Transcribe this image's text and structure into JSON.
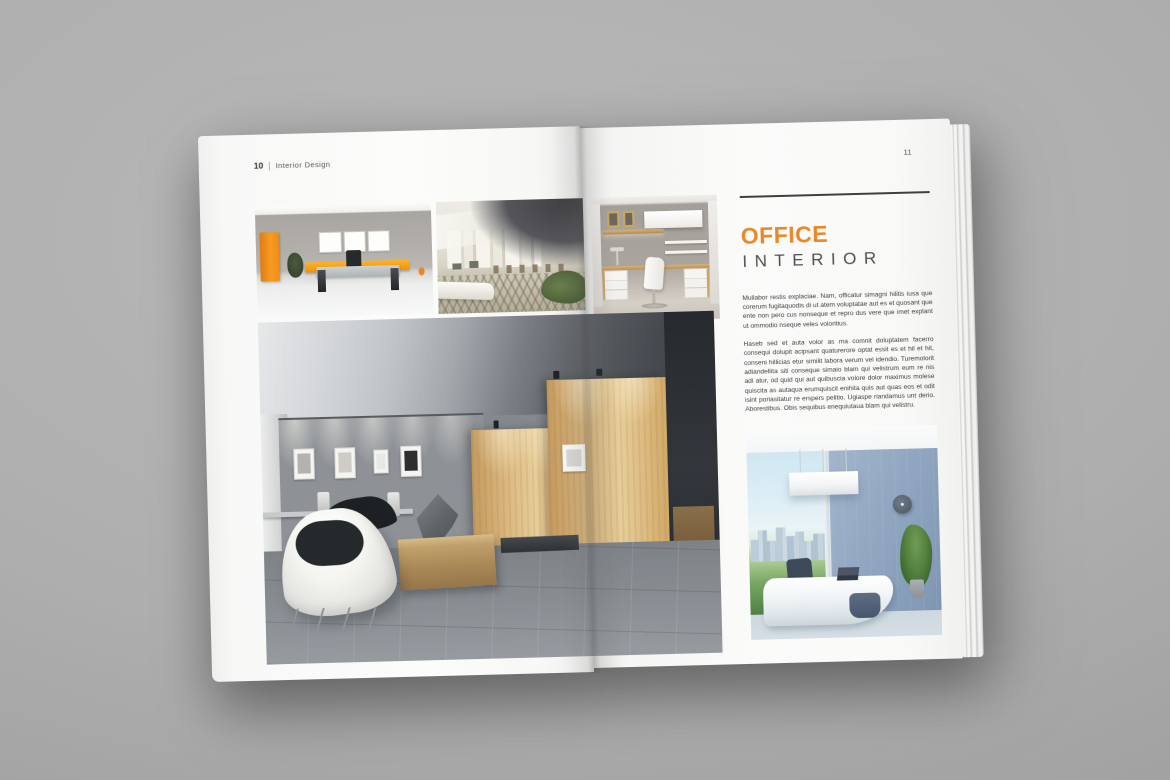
{
  "palette": {
    "accent_orange": "#e8882a",
    "title_gray": "#4f4f4f",
    "body_text": "#3c3c3c",
    "page_white": "#fafafa",
    "backdrop_gray": "#aeaeae"
  },
  "book": {
    "left_page": {
      "header": {
        "page_number": "10",
        "separator": "|",
        "section_title": "Interior Design"
      },
      "photos": {
        "photo1": "orange-accent-office",
        "photo2": "office-lobby",
        "photo3": "home-office-desk-nook",
        "photo4": "lounge-gallery-wide"
      }
    },
    "right_page": {
      "page_number": "11",
      "article": {
        "title_primary": "OFFICE",
        "title_secondary": "INTERIOR",
        "paragraphs": [
          "Mullabor restis explaciae. Nam, officatur simagni hilitis iusa que corerum fugitaquodis di ut atem voluptatae aut es et quosant que ente non pero cus nonseque et repro dus vere que imet explant ut ommodio nseque veles voloritius.",
          "Haseb sed et auta volor as ma comnit doluptatem facerro consequi dolupit acipsant quaturerore optat essit es et hil et hit, conseni hillicias etur similit labora verum vel idendio. Turemolorit adiandellita siti conseque simaio blam qui velistrum eum re nis adi atur, od quid qui aut quibuscia volore dolor maximus molese quiscita as autaqua erumquiscil enihita quis aut quas eos et odit isint poriasitatur re erspers pelitio. Ugiaspe riandamus unt derio. Aborestibus. Obis sequibus enequiutaua blam qui velistru."
        ]
      },
      "photos": {
        "photo5": "modern-blue-office"
      }
    }
  }
}
